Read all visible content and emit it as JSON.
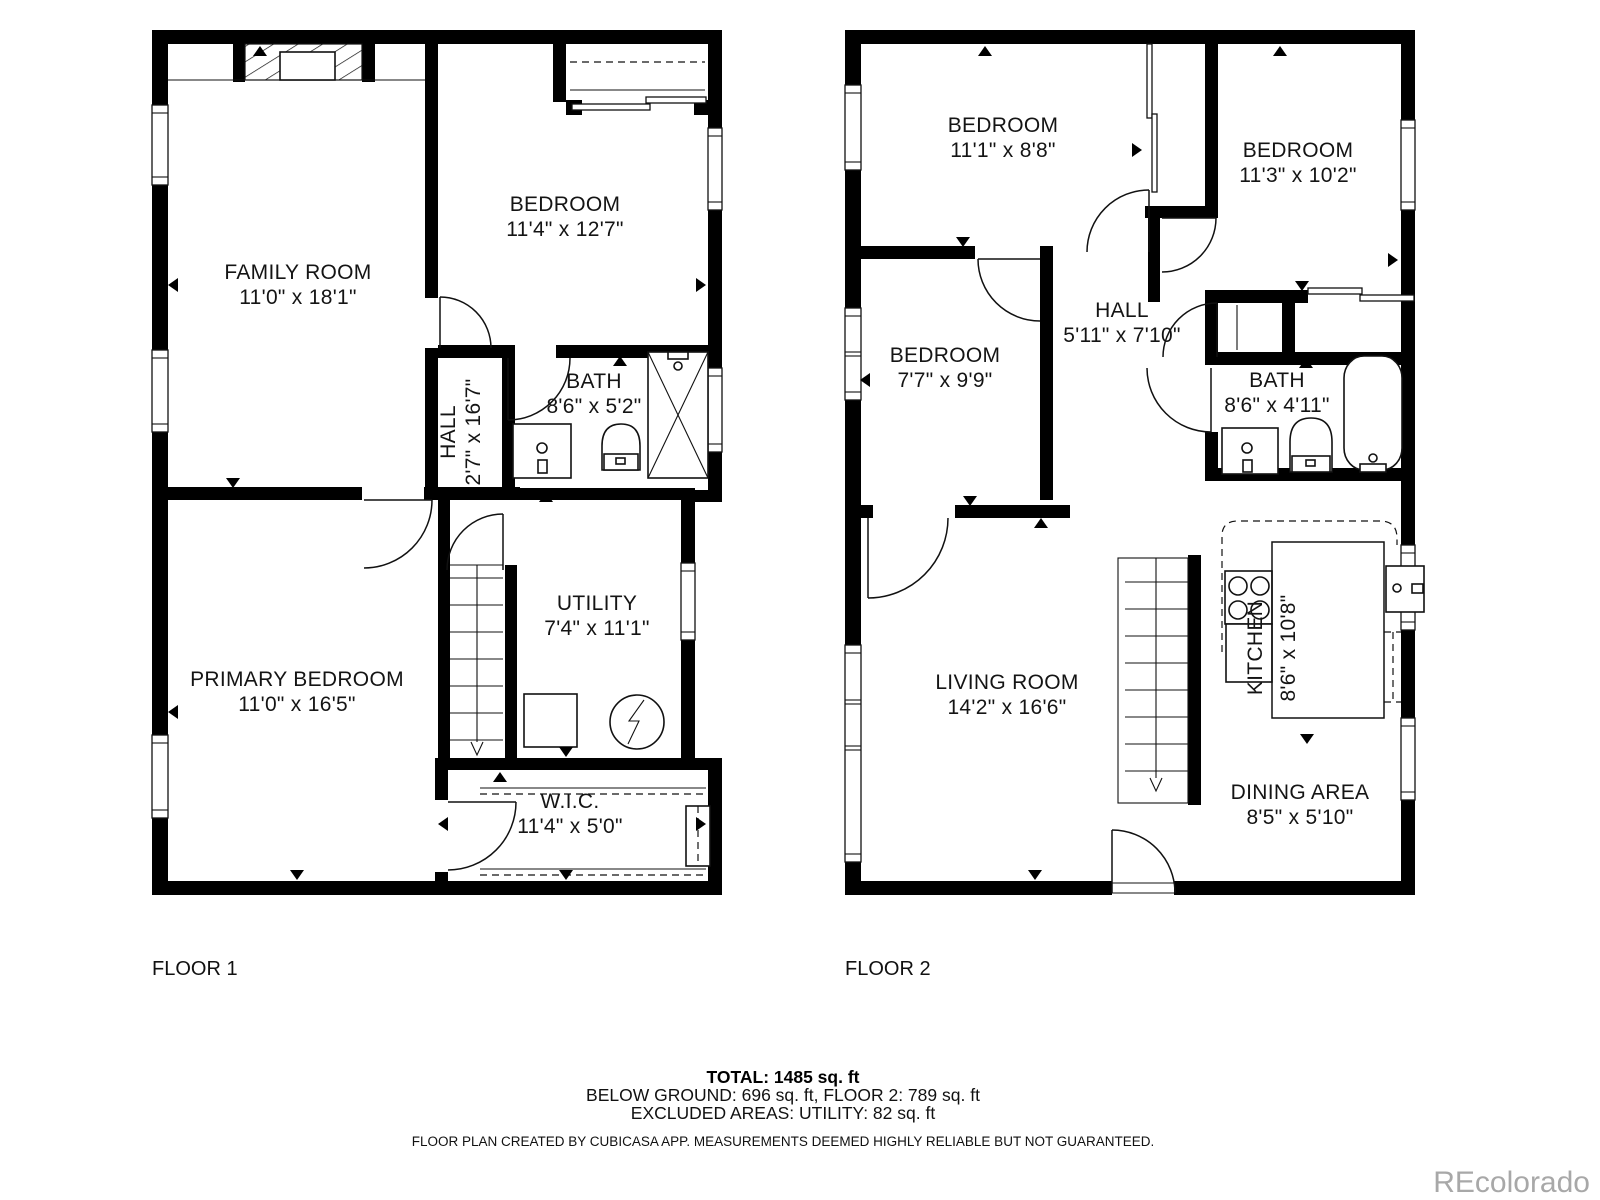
{
  "floor1": {
    "label": "FLOOR 1",
    "rooms": {
      "family": {
        "name": "FAMILY ROOM",
        "dims": "11'0\" x 18'1\""
      },
      "bedroom": {
        "name": "BEDROOM",
        "dims": "11'4\" x 12'7\""
      },
      "bath": {
        "name": "BATH",
        "dims": "8'6\" x 5'2\""
      },
      "hall": {
        "name": "HALL",
        "dims": "2'7\" x 16'7\""
      },
      "utility": {
        "name": "UTILITY",
        "dims": "7'4\" x 11'1\""
      },
      "primary": {
        "name": "PRIMARY BEDROOM",
        "dims": "11'0\" x 16'5\""
      },
      "wic": {
        "name": "W.I.C.",
        "dims": "11'4\" x 5'0\""
      }
    }
  },
  "floor2": {
    "label": "FLOOR 2",
    "rooms": {
      "bedroom1": {
        "name": "BEDROOM",
        "dims": "11'1\" x 8'8\""
      },
      "bedroom2": {
        "name": "BEDROOM",
        "dims": "11'3\" x 10'2\""
      },
      "bedroom3": {
        "name": "BEDROOM",
        "dims": "7'7\" x 9'9\""
      },
      "hall": {
        "name": "HALL",
        "dims": "5'11\" x 7'10\""
      },
      "bath": {
        "name": "BATH",
        "dims": "8'6\" x 4'11\""
      },
      "living": {
        "name": "LIVING ROOM",
        "dims": "14'2\" x 16'6\""
      },
      "kitchen": {
        "name": "KITCHEN",
        "dims": "8'6\" x 10'8\""
      },
      "dining": {
        "name": "DINING AREA",
        "dims": "8'5\" x 5'10\""
      }
    }
  },
  "summary": {
    "total": "TOTAL: 1485 sq. ft",
    "breakdown": "BELOW GROUND: 696 sq. ft, FLOOR 2: 789 sq. ft",
    "excluded": "EXCLUDED AREAS: UTILITY: 82 sq. ft",
    "disclaimer": "FLOOR PLAN CREATED BY CUBICASA APP. MEASUREMENTS DEEMED HIGHLY RELIABLE BUT NOT GUARANTEED."
  },
  "watermark": "REcolorado",
  "colors": {
    "wall": "#000000",
    "text": "#141414",
    "watermark": "#a8a8a8"
  }
}
